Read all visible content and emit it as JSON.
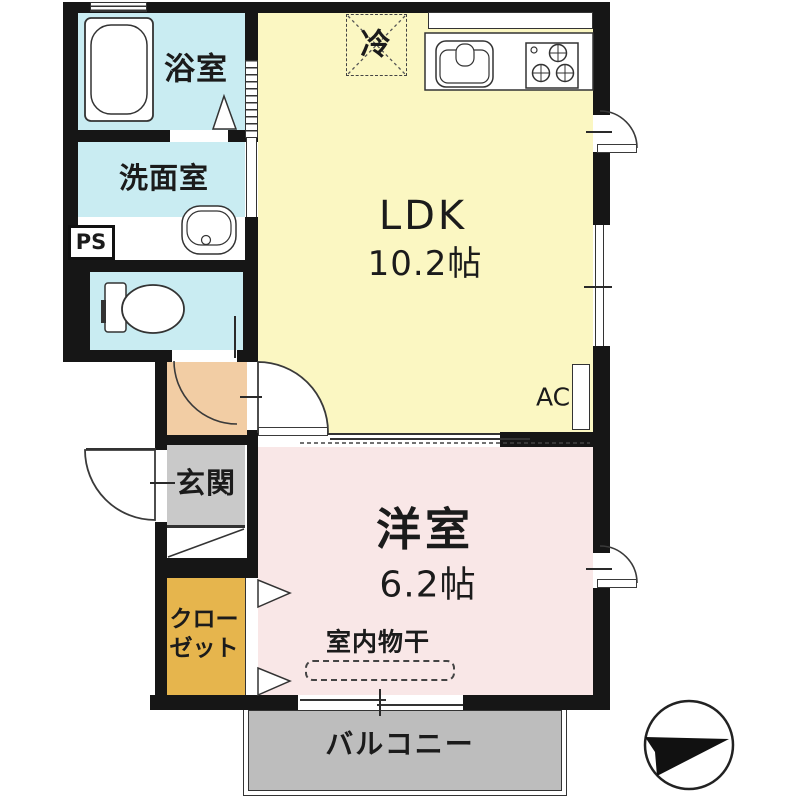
{
  "floorplan": {
    "title": "1LDK apartment floor plan",
    "rooms": {
      "bathroom": {
        "label": "浴室"
      },
      "washroom": {
        "label": "洗面室"
      },
      "pipe_space": {
        "label": "PS"
      },
      "refrigerator": {
        "label": "冷"
      },
      "ldk": {
        "label": "LDK",
        "size": "10.2帖"
      },
      "ac": {
        "label": "AC"
      },
      "entrance": {
        "label": "玄関"
      },
      "closet": {
        "label": "クロー\nゼット"
      },
      "western_room": {
        "label": "洋室",
        "size": "6.2帖"
      },
      "indoor_drying": {
        "label": "室内物干"
      },
      "balcony": {
        "label": "バルコニー"
      }
    },
    "icons": {
      "compass": "north-arrow-icon",
      "bathtub": "bathtub-icon",
      "toilet": "toilet-icon",
      "washbasin": "washbasin-icon",
      "kitchen_sink": "kitchen-sink-icon",
      "stove": "gas-stove-icon"
    },
    "colors": {
      "wet_cyan": "#c9ecf2",
      "ldk_yellow": "#fbf7c2",
      "room_pink": "#f9e7e7",
      "hall_peach": "#f2cda4",
      "closet_gold": "#e6b54d",
      "entrance_gray": "#c9c9c9",
      "balcony_gray": "#bdbdbd",
      "wall": "#161616"
    }
  }
}
